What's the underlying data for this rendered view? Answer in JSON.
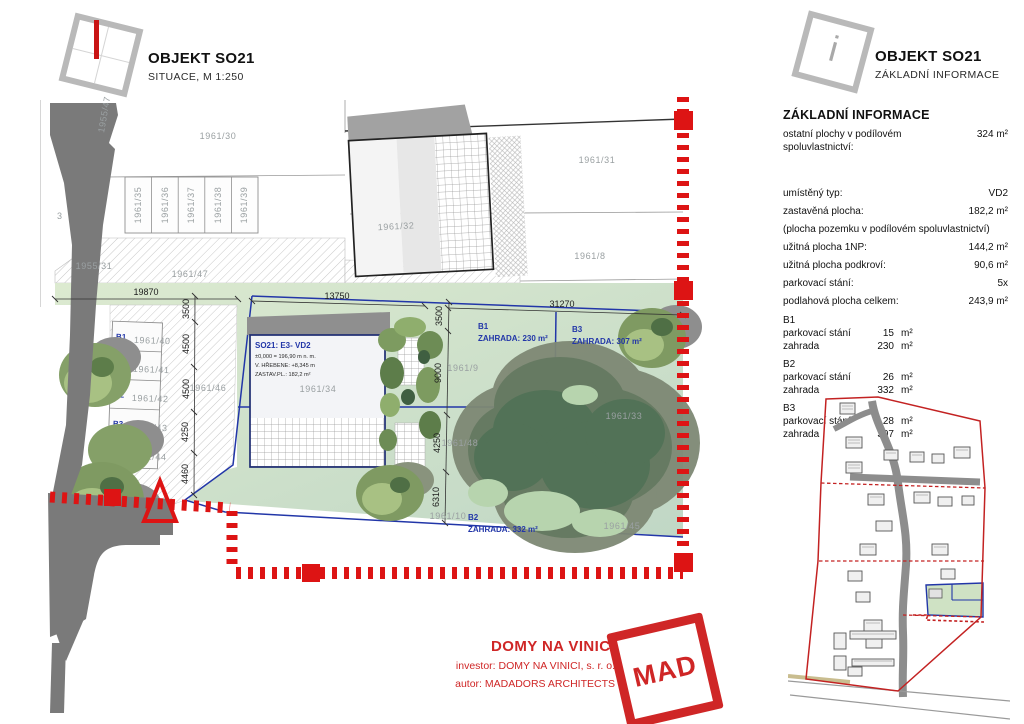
{
  "header_left": {
    "title": "OBJEKT SO21",
    "subtitle": "SITUACE, M 1:250"
  },
  "header_right": {
    "title": "OBJEKT SO21",
    "subtitle": "ZÁKLADNÍ INFORMACE",
    "icon_letter": "i"
  },
  "info_panel": {
    "heading": "ZÁKLADNÍ INFORMACE",
    "shared_row": {
      "label": "ostatní plochy v podílovém spoluvlastnictví:",
      "value": "324 m²"
    },
    "rows": [
      {
        "label": "umístěný typ:",
        "value": "VD2"
      },
      {
        "label": "zastavěná plocha:",
        "value": "182,2 m²"
      },
      {
        "label": "(plocha pozemku v podílovém spoluvlastnictví)",
        "value": ""
      },
      {
        "label": "užitná plocha 1NP:",
        "value": "144,2 m²"
      },
      {
        "label": "užitná plocha podkroví:",
        "value": "90,6 m²"
      },
      {
        "label": "parkovací stání:",
        "value": "5x"
      },
      {
        "label": "podlahová plocha celkem:",
        "value": "243,9 m²"
      }
    ],
    "units": [
      {
        "name": "B1",
        "rows": [
          {
            "label": "parkovací stání",
            "value": "15",
            "unit": "m²"
          },
          {
            "label": "zahrada",
            "value": "230",
            "unit": "m²"
          }
        ]
      },
      {
        "name": "B2",
        "rows": [
          {
            "label": "parkovací stání",
            "value": "26",
            "unit": "m²"
          },
          {
            "label": "zahrada",
            "value": "332",
            "unit": "m²"
          }
        ]
      },
      {
        "name": "B3",
        "rows": [
          {
            "label": "parkovací stání",
            "value": "28",
            "unit": "m²"
          },
          {
            "label": "zahrada",
            "value": "307",
            "unit": "m²"
          }
        ]
      }
    ]
  },
  "plan": {
    "parcels": {
      "p30": "1961/30",
      "p31": "1961/31",
      "p32": "1961/32",
      "p8": "1961/8",
      "p47": "1961/47",
      "p55_31": "1955/31",
      "p55_47": "1955/47",
      "p3": "3",
      "p46": "1961/46",
      "p34": "1961/34",
      "p9": "1961/9",
      "p48": "1961/48",
      "p10": "1961/10",
      "p45": "1961/45",
      "p33": "1961/33"
    },
    "top_stalls": [
      "1961/35",
      "1961/36",
      "1961/37",
      "1961/38",
      "1961/39"
    ],
    "parking_stalls": [
      {
        "b": "B1",
        "parcel": "1961/40"
      },
      {
        "b": "B2",
        "parcel": "1961/41"
      },
      {
        "b": "B2",
        "parcel": "1961/42"
      },
      {
        "b": "B3",
        "parcel": "1961/43"
      },
      {
        "b": "B3",
        "parcel": "1961/44"
      }
    ],
    "gardens": {
      "b1": {
        "name": "B1",
        "area": "ZAHRADA: 230 m²"
      },
      "b3": {
        "name": "B3",
        "area": "ZAHRADA: 307 m²"
      },
      "b2": {
        "name": "B2",
        "area": "ZAHRADA: 332 m²"
      }
    },
    "building": {
      "title": "SO21: E3- VD2",
      "elevation": "±0,000 = 196,90 m n. m.",
      "ridge": "V. HŘEBENE: +8,345 m",
      "footprint": "ZASTAV.PL.: 182,2 m²"
    },
    "dims": {
      "d19870": "19870",
      "d13750": "13750",
      "d31270": "31270",
      "left": [
        "3500",
        "4500",
        "4500",
        "4250",
        "4460"
      ],
      "right": [
        "3500",
        "9000",
        "4250",
        "6310"
      ]
    }
  },
  "footer": {
    "project": "DOMY NA VINICI",
    "investor": "investor: DOMY NA VINICI, s. r. o.",
    "author": "autor: MADADORS ARCHITECTS",
    "logo_text": "MAD"
  },
  "colors": {
    "accent_red": "#cf2626",
    "plan_blue": "#2236a8",
    "plot_green": "#cfe2c8"
  }
}
